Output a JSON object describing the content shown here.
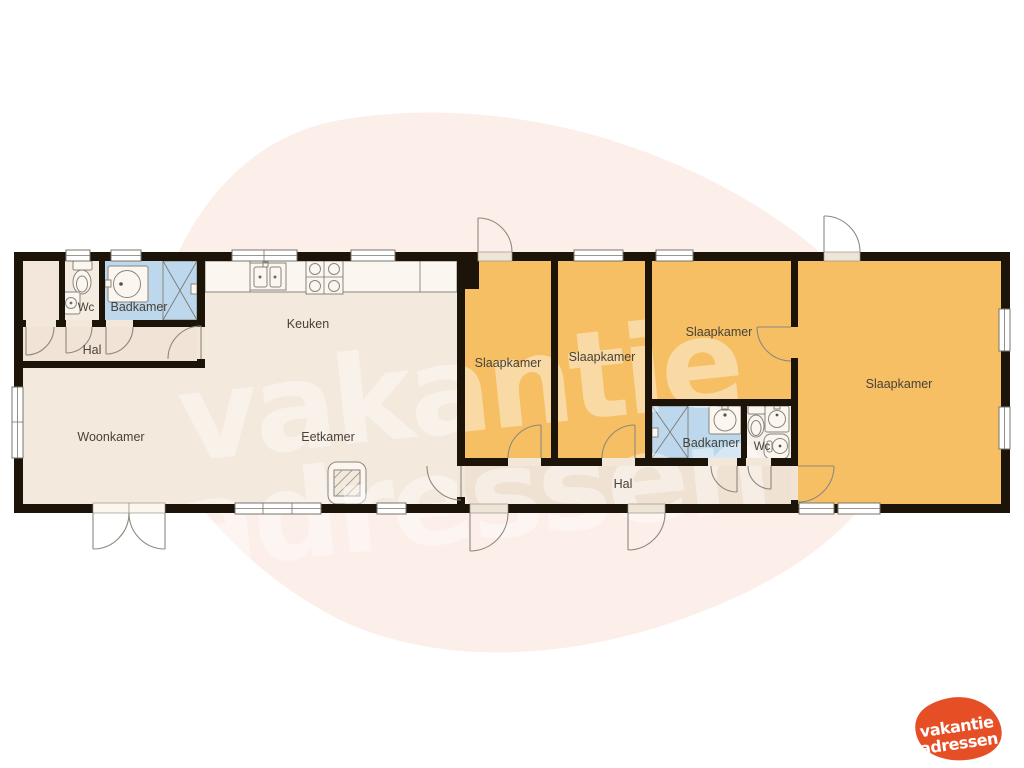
{
  "floorplan": {
    "rooms": {
      "wc_left": {
        "label": "Wc"
      },
      "badkamer_left": {
        "label": "Badkamer"
      },
      "hal_left": {
        "label": "Hal"
      },
      "keuken": {
        "label": "Keuken"
      },
      "woonkamer": {
        "label": "Woonkamer"
      },
      "eetkamer": {
        "label": "Eetkamer"
      },
      "slaapkamer_1": {
        "label": "Slaapkamer"
      },
      "slaapkamer_2": {
        "label": "Slaapkamer"
      },
      "slaapkamer_3": {
        "label": "Slaapkamer"
      },
      "slaapkamer_4": {
        "label": "Slaapkamer"
      },
      "badkamer_right": {
        "label": "Badkamer"
      },
      "wc_right": {
        "label": "Wc"
      },
      "hal_right": {
        "label": "Hal"
      }
    },
    "colors": {
      "wall": "#1c1309",
      "bedroom": "#f6bf63",
      "bathroom": "#bdd7ec",
      "living": "#f4e9dd",
      "hall": "#f0e2d3",
      "counter": "#f8f1e7",
      "background_blob": "#fcefe9",
      "logo_orange": "#e64e25"
    },
    "fixtures": [
      "toilet-icon",
      "washbasin-icon",
      "shower-icon",
      "kitchen-sink-icon",
      "stove-icon",
      "fireplace-icon",
      "boiler-icon"
    ]
  },
  "watermark": {
    "line1": "vakantie",
    "line2": "adressen"
  },
  "logo": {
    "line1": "vakantie",
    "line2": "adressen"
  }
}
